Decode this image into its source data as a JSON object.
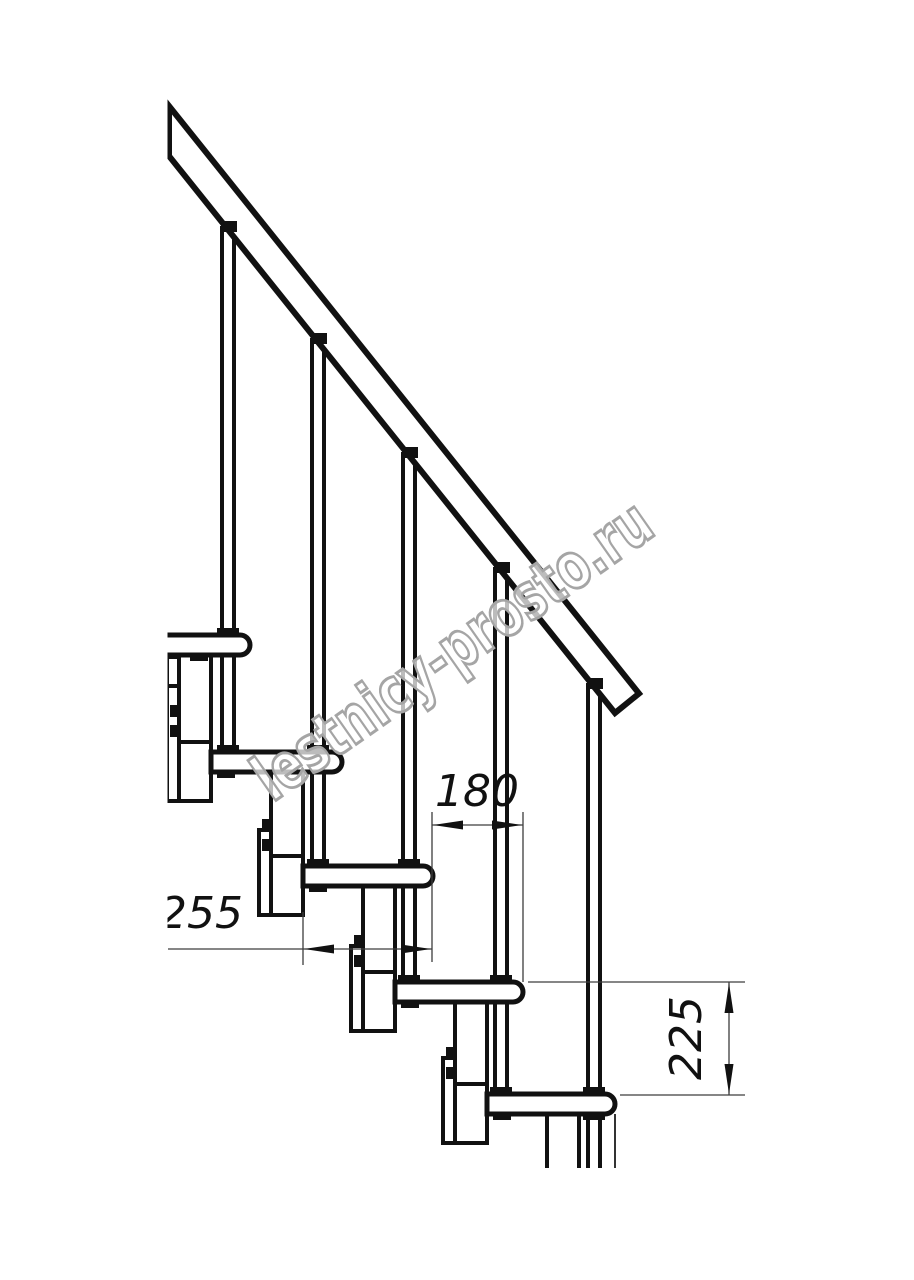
{
  "drawing": {
    "type": "staircase-side-view-technical-drawing",
    "watermark_text": "lestnicy-prosto.ru",
    "dimensions": {
      "step_run": "180",
      "tread_depth": "255",
      "riser_height": "225"
    },
    "colors": {
      "line": "#111111",
      "thin_line": "#3d3d3d",
      "watermark_outline": "#a5a5a5",
      "background": "#ffffff"
    }
  }
}
